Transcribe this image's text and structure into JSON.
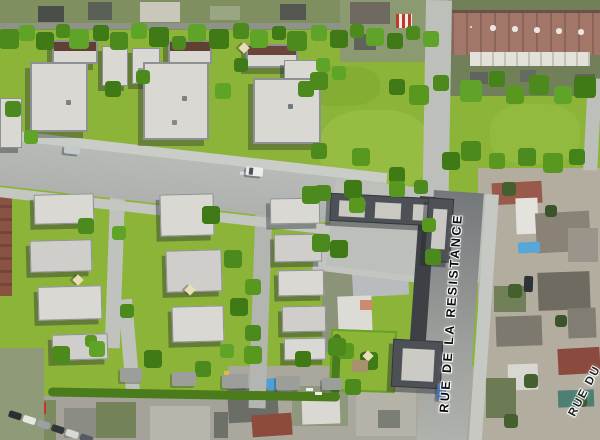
{
  "image": {
    "type": "aerial-site-plan-render",
    "width": 600,
    "height": 440
  },
  "labels": {
    "street_primary": "RUE DE LA RESISTANCE",
    "street_secondary": "RUE DU"
  },
  "palette": {
    "grass_render": "#8cb438",
    "grass_satellite": "#77855c",
    "tree_dark": "#3f7a17",
    "tree_mid": "#4c8a1d",
    "tree_light": "#5fa328",
    "roof_light": "#d9d8d3",
    "roof_charcoal": "#4d5156",
    "roof_brown": "#5f4033",
    "roof_satellite_red": "#96584a",
    "road_light": "#b4b7b3",
    "street_asphalt": "#7a7e81",
    "satellite_base": "#b3ada0"
  }
}
